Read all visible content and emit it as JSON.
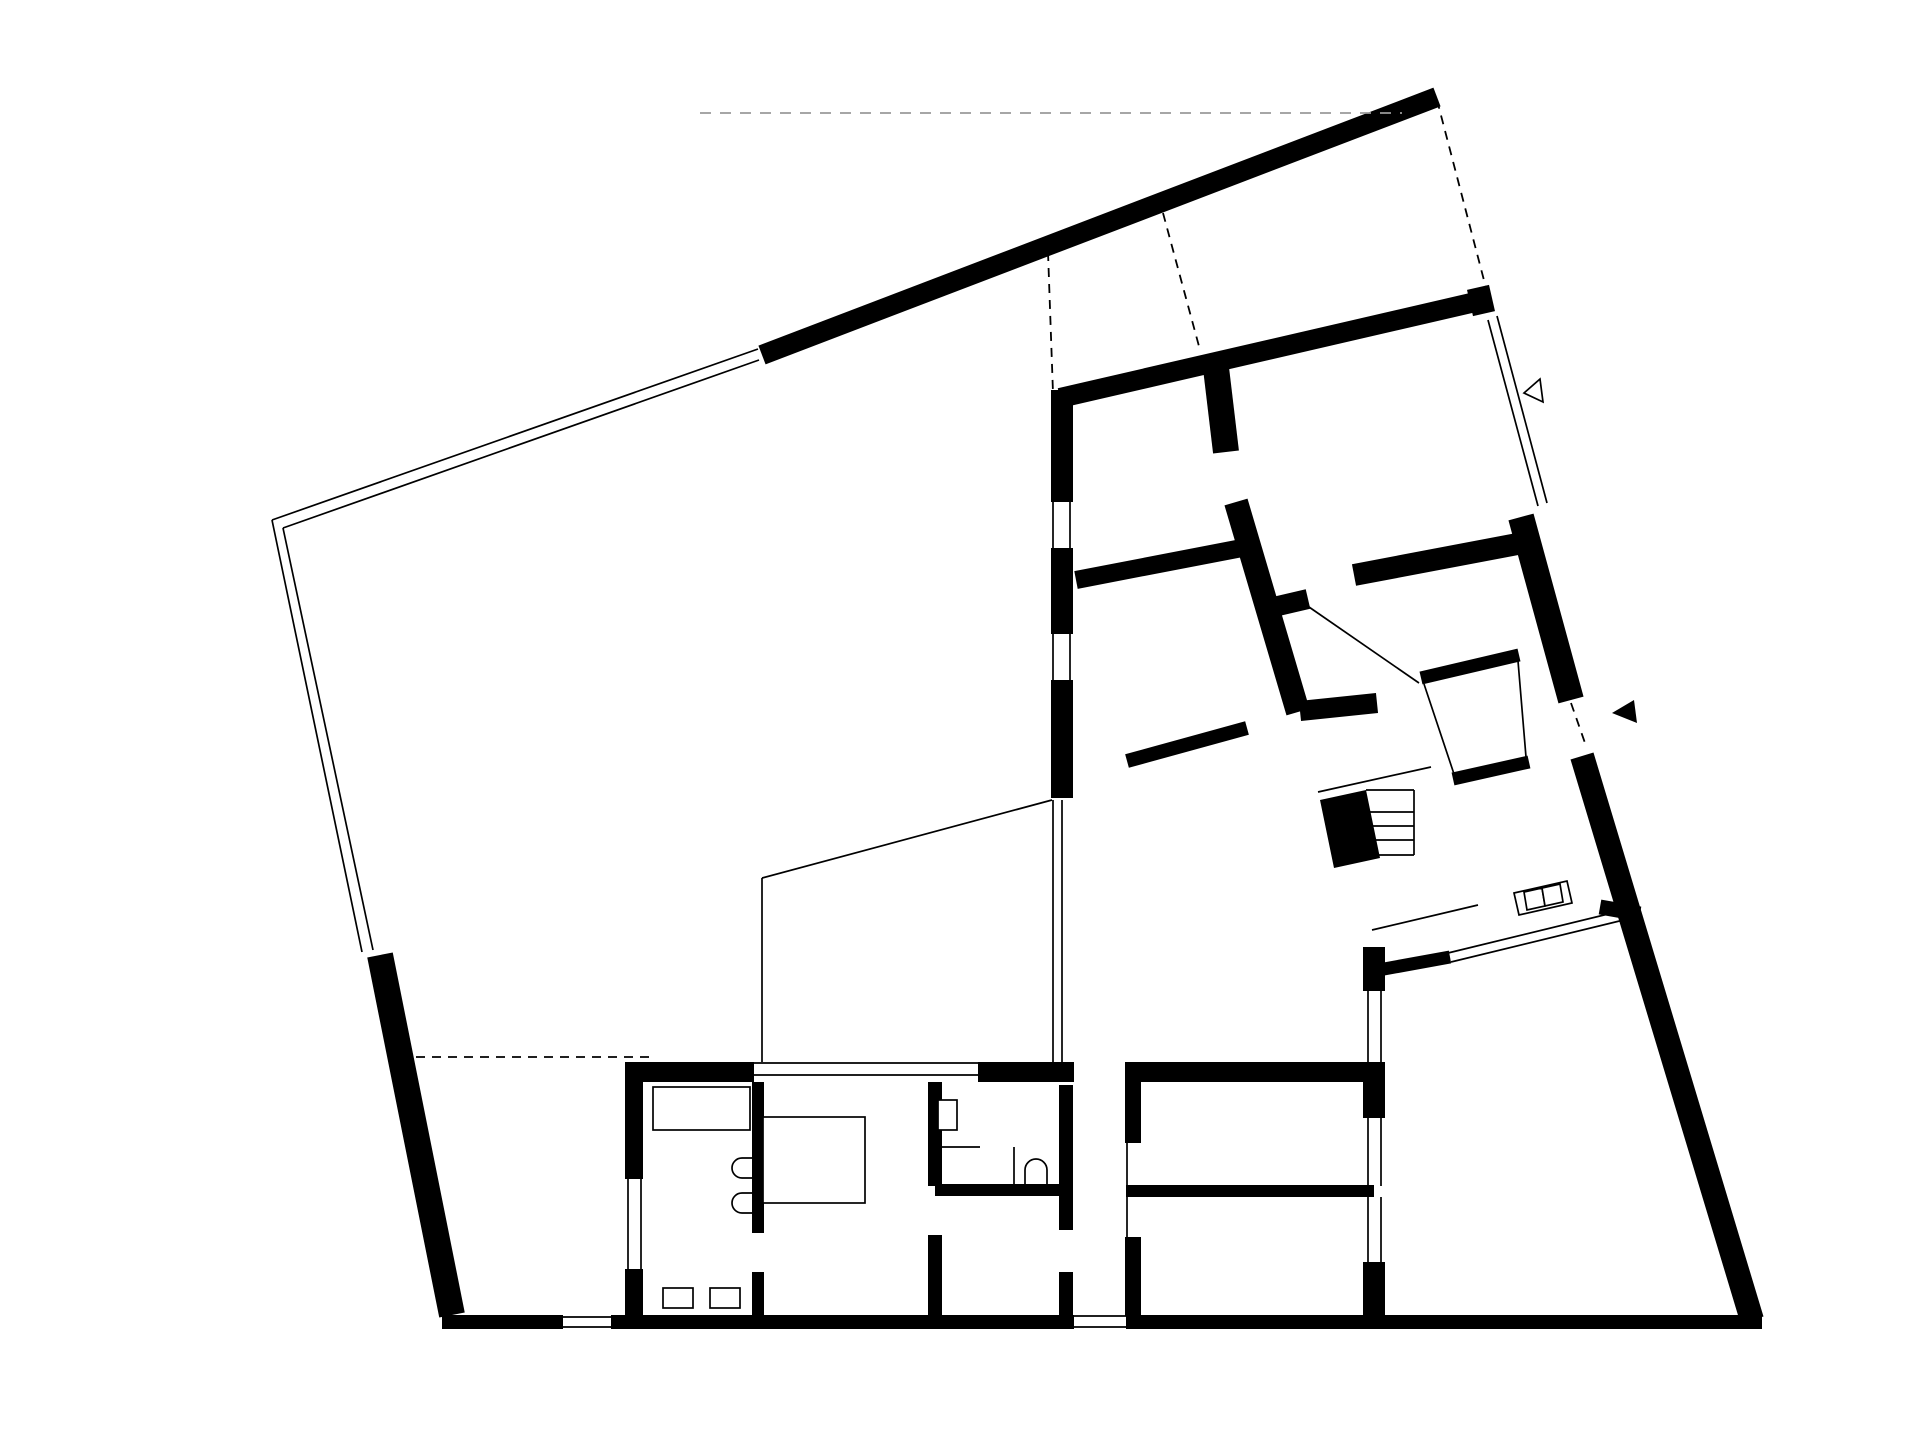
{
  "meta": {
    "drawing": "architectural-floor-plan",
    "canvas": {
      "width": 1920,
      "height": 1437
    },
    "colors": {
      "ink": "#000000",
      "background": "#ffffff",
      "faint": "#9a9a9a"
    }
  },
  "plan": {
    "walls": [
      {
        "name": "boundary-wall-top",
        "x1": 762,
        "y1": 355,
        "x2": 1437,
        "y2": 97,
        "w": 20
      },
      {
        "name": "boundary-wall-left",
        "x1": 380,
        "y1": 955,
        "x2": 452,
        "y2": 1315,
        "w": 26
      },
      {
        "name": "boundary-wall-bottom-a",
        "x1": 442,
        "y1": 1322,
        "x2": 563,
        "y2": 1322,
        "w": 14
      },
      {
        "name": "boundary-wall-bottom-b",
        "x1": 611,
        "y1": 1322,
        "x2": 1074,
        "y2": 1322,
        "w": 14
      },
      {
        "name": "boundary-wall-bottom-c",
        "x1": 1126,
        "y1": 1322,
        "x2": 1762,
        "y2": 1322,
        "w": 14
      },
      {
        "name": "boundary-wall-right-upper",
        "x1": 1521,
        "y1": 517,
        "x2": 1571,
        "y2": 700,
        "w": 26
      },
      {
        "name": "boundary-wall-right-lower",
        "x1": 1582,
        "y1": 756,
        "x2": 1752,
        "y2": 1320,
        "w": 24
      },
      {
        "name": "house-wall-top",
        "x1": 1060,
        "y1": 398,
        "x2": 1484,
        "y2": 300,
        "w": 20
      },
      {
        "name": "house-wall-top-end-block",
        "x1": 1470,
        "y1": 303,
        "x2": 1492,
        "y2": 298,
        "w": 27
      },
      {
        "name": "house-wall-west-a",
        "x1": 1062,
        "y1": 390,
        "x2": 1062,
        "y2": 502,
        "w": 22
      },
      {
        "name": "house-wall-west-b",
        "x1": 1062,
        "y1": 548,
        "x2": 1062,
        "y2": 634,
        "w": 22
      },
      {
        "name": "house-wall-west-c",
        "x1": 1062,
        "y1": 680,
        "x2": 1062,
        "y2": 798,
        "w": 22
      },
      {
        "name": "partition-p1-upper",
        "x1": 1216,
        "y1": 368,
        "x2": 1226,
        "y2": 452,
        "w": 26
      },
      {
        "name": "partition-p1-lower",
        "x1": 1236,
        "y1": 502,
        "x2": 1298,
        "y2": 712,
        "w": 24
      },
      {
        "name": "partition-p1-stub",
        "x1": 1278,
        "y1": 606,
        "x2": 1308,
        "y2": 599,
        "w": 20
      },
      {
        "name": "partition-room-ab",
        "x1": 1076,
        "y1": 580,
        "x2": 1242,
        "y2": 548,
        "w": 18
      },
      {
        "name": "partition-hall-west",
        "x1": 1300,
        "y1": 711,
        "x2": 1377,
        "y2": 703,
        "w": 20
      },
      {
        "name": "partition-room-c-south",
        "x1": 1354,
        "y1": 575,
        "x2": 1528,
        "y2": 542,
        "w": 22
      },
      {
        "name": "closet-wall-nw",
        "x1": 1421,
        "y1": 678,
        "x2": 1519,
        "y2": 655,
        "w": 13
      },
      {
        "name": "closet-wall-se",
        "x1": 1453,
        "y1": 779,
        "x2": 1529,
        "y2": 762,
        "w": 13
      },
      {
        "name": "terrace-wall-top",
        "x1": 1373,
        "y1": 971,
        "x2": 1450,
        "y2": 957,
        "w": 13
      },
      {
        "name": "terrace-glazing-junction",
        "x1": 1600,
        "y1": 907,
        "x2": 1640,
        "y2": 914,
        "w": 15
      },
      {
        "name": "terrace-wall-west-a",
        "x1": 1374,
        "y1": 947,
        "x2": 1374,
        "y2": 991,
        "w": 22
      },
      {
        "name": "terrace-wall-west-b",
        "x1": 1374,
        "y1": 1062,
        "x2": 1374,
        "y2": 1118,
        "w": 22
      },
      {
        "name": "terrace-wall-west-c",
        "x1": 1374,
        "y1": 1262,
        "x2": 1374,
        "y2": 1316,
        "w": 22
      },
      {
        "name": "rooms-de-wall-top",
        "x1": 1126,
        "y1": 1072,
        "x2": 1374,
        "y2": 1072,
        "w": 20
      },
      {
        "name": "rooms-de-wall-west-a",
        "x1": 1133,
        "y1": 1062,
        "x2": 1133,
        "y2": 1143,
        "w": 16
      },
      {
        "name": "rooms-de-wall-west-b",
        "x1": 1133,
        "y1": 1237,
        "x2": 1133,
        "y2": 1316,
        "w": 16
      },
      {
        "name": "rooms-de-divider",
        "x1": 1126,
        "y1": 1191,
        "x2": 1374,
        "y2": 1191,
        "w": 12
      },
      {
        "name": "wing-wall-top-a",
        "x1": 625,
        "y1": 1072,
        "x2": 754,
        "y2": 1072,
        "w": 20
      },
      {
        "name": "wing-wall-top-b",
        "x1": 978,
        "y1": 1072,
        "x2": 1074,
        "y2": 1072,
        "w": 20
      },
      {
        "name": "utility-wall-west-a",
        "x1": 634,
        "y1": 1062,
        "x2": 634,
        "y2": 1179,
        "w": 18
      },
      {
        "name": "utility-wall-west-b",
        "x1": 634,
        "y1": 1269,
        "x2": 634,
        "y2": 1316,
        "w": 18
      },
      {
        "name": "utility-bedroom-divider-a",
        "x1": 758,
        "y1": 1082,
        "x2": 758,
        "y2": 1233,
        "w": 12
      },
      {
        "name": "utility-bedroom-divider-b",
        "x1": 758,
        "y1": 1272,
        "x2": 758,
        "y2": 1316,
        "w": 12
      },
      {
        "name": "bath-wall-west-a",
        "x1": 935,
        "y1": 1082,
        "x2": 935,
        "y2": 1186,
        "w": 14
      },
      {
        "name": "bath-wall-west-b",
        "x1": 935,
        "y1": 1235,
        "x2": 935,
        "y2": 1316,
        "w": 14
      },
      {
        "name": "bath-wall-east-a",
        "x1": 1066,
        "y1": 1085,
        "x2": 1066,
        "y2": 1230,
        "w": 14
      },
      {
        "name": "bath-wall-east-b",
        "x1": 1066,
        "y1": 1272,
        "x2": 1066,
        "y2": 1316,
        "w": 14
      },
      {
        "name": "bath-divider-south",
        "x1": 935,
        "y1": 1190,
        "x2": 1066,
        "y2": 1190,
        "w": 12
      },
      {
        "name": "kitchen-island-wall",
        "x1": 1127,
        "y1": 761,
        "x2": 1247,
        "y2": 728,
        "w": 14
      }
    ],
    "thin_lines": [
      {
        "name": "fence-top-outer",
        "x1": 272,
        "y1": 520,
        "x2": 758,
        "y2": 349
      },
      {
        "name": "fence-top-inner",
        "x1": 283,
        "y1": 528,
        "x2": 759,
        "y2": 360
      },
      {
        "name": "fence-left-outer",
        "x1": 272,
        "y1": 520,
        "x2": 362,
        "y2": 952
      },
      {
        "name": "fence-left-inner",
        "x1": 283,
        "y1": 528,
        "x2": 373,
        "y2": 950
      },
      {
        "name": "glazing-ne-a",
        "x1": 1488,
        "y1": 320,
        "x2": 1538,
        "y2": 506
      },
      {
        "name": "glazing-ne-b",
        "x1": 1497,
        "y1": 316,
        "x2": 1547,
        "y2": 503
      },
      {
        "name": "patio-glazing-a",
        "x1": 1053,
        "y1": 800,
        "x2": 1053,
        "y2": 1062
      },
      {
        "name": "patio-glazing-b",
        "x1": 1062,
        "y1": 800,
        "x2": 1062,
        "y2": 1062
      },
      {
        "name": "patio-edge-diagonal",
        "x1": 762,
        "y1": 878,
        "x2": 1052,
        "y2": 800
      },
      {
        "name": "patio-edge-west",
        "x1": 762,
        "y1": 878,
        "x2": 762,
        "y2": 1062
      },
      {
        "name": "window-west1-a",
        "x1": 1053,
        "y1": 502,
        "x2": 1053,
        "y2": 548
      },
      {
        "name": "window-west1-b",
        "x1": 1070,
        "y1": 502,
        "x2": 1070,
        "y2": 548
      },
      {
        "name": "window-west2-a",
        "x1": 1053,
        "y1": 634,
        "x2": 1053,
        "y2": 680
      },
      {
        "name": "window-west2-b",
        "x1": 1070,
        "y1": 634,
        "x2": 1070,
        "y2": 680
      },
      {
        "name": "window-bedroom-a",
        "x1": 754,
        "y1": 1063,
        "x2": 978,
        "y2": 1063
      },
      {
        "name": "window-bedroom-b",
        "x1": 754,
        "y1": 1075,
        "x2": 978,
        "y2": 1075
      },
      {
        "name": "window-utility-a",
        "x1": 628,
        "y1": 1179,
        "x2": 628,
        "y2": 1269
      },
      {
        "name": "window-utility-b",
        "x1": 641,
        "y1": 1179,
        "x2": 641,
        "y2": 1269
      },
      {
        "name": "window-terrace1-a",
        "x1": 1368,
        "y1": 991,
        "x2": 1368,
        "y2": 1062
      },
      {
        "name": "window-terrace1-b",
        "x1": 1381,
        "y1": 991,
        "x2": 1381,
        "y2": 1062
      },
      {
        "name": "window-terrace2-a",
        "x1": 1368,
        "y1": 1118,
        "x2": 1368,
        "y2": 1186
      },
      {
        "name": "window-terrace2-b",
        "x1": 1381,
        "y1": 1118,
        "x2": 1381,
        "y2": 1186
      },
      {
        "name": "window-terrace3-a",
        "x1": 1368,
        "y1": 1197,
        "x2": 1368,
        "y2": 1262
      },
      {
        "name": "window-terrace3-b",
        "x1": 1381,
        "y1": 1197,
        "x2": 1381,
        "y2": 1262
      },
      {
        "name": "door-line-rooms-de",
        "x1": 1127,
        "y1": 1143,
        "x2": 1127,
        "y2": 1237
      },
      {
        "name": "gate-line-a",
        "x1": 563,
        "y1": 1317,
        "x2": 611,
        "y2": 1317
      },
      {
        "name": "gate-line-b",
        "x1": 563,
        "y1": 1327,
        "x2": 611,
        "y2": 1327
      },
      {
        "name": "window-hall-south-a",
        "x1": 1074,
        "y1": 1316,
        "x2": 1126,
        "y2": 1316
      },
      {
        "name": "window-hall-south-b",
        "x1": 1074,
        "y1": 1327,
        "x2": 1126,
        "y2": 1327
      },
      {
        "name": "terrace-glazing-a",
        "x1": 1448,
        "y1": 953,
        "x2": 1637,
        "y2": 907
      },
      {
        "name": "terrace-glazing-b",
        "x1": 1451,
        "y1": 962,
        "x2": 1640,
        "y2": 916
      },
      {
        "name": "kitchen-glazing-line",
        "x1": 1372,
        "y1": 930,
        "x2": 1478,
        "y2": 905
      },
      {
        "name": "door-swing-room-c",
        "x1": 1309,
        "y1": 607,
        "x2": 1419,
        "y2": 683
      },
      {
        "name": "closet-side-sw",
        "x1": 1424,
        "y1": 684,
        "x2": 1454,
        "y2": 774
      },
      {
        "name": "closet-side-ne",
        "x1": 1518,
        "y1": 661,
        "x2": 1526,
        "y2": 757
      },
      {
        "name": "stair-rail",
        "x1": 1318,
        "y1": 792,
        "x2": 1431,
        "y2": 767
      },
      {
        "name": "stair-edge-top",
        "x1": 1366,
        "y1": 790,
        "x2": 1414,
        "y2": 790
      },
      {
        "name": "stair-tread-1",
        "x1": 1366,
        "y1": 812,
        "x2": 1414,
        "y2": 812
      },
      {
        "name": "stair-tread-2",
        "x1": 1366,
        "y1": 826,
        "x2": 1414,
        "y2": 826
      },
      {
        "name": "stair-tread-3",
        "x1": 1366,
        "y1": 840,
        "x2": 1414,
        "y2": 840
      },
      {
        "name": "stair-edge-bottom",
        "x1": 1366,
        "y1": 855,
        "x2": 1414,
        "y2": 855
      },
      {
        "name": "stair-edge-right",
        "x1": 1414,
        "y1": 790,
        "x2": 1414,
        "y2": 855
      },
      {
        "name": "bed-fold-line",
        "x1": 775,
        "y1": 1117,
        "x2": 790,
        "y2": 1203
      },
      {
        "name": "bath-screen-line",
        "x1": 1014,
        "y1": 1147,
        "x2": 1014,
        "y2": 1188
      },
      {
        "name": "bath-shelf-line",
        "x1": 938,
        "y1": 1147,
        "x2": 980,
        "y2": 1147
      }
    ],
    "dashed_lines": [
      {
        "name": "dash-roof-edge-west",
        "x1": 1048,
        "y1": 252,
        "x2": 1053,
        "y2": 393,
        "faint": false
      },
      {
        "name": "dash-roof-edge-mid",
        "x1": 1163,
        "y1": 213,
        "x2": 1200,
        "y2": 350,
        "faint": false
      },
      {
        "name": "dash-boundary-ne",
        "x1": 1437,
        "y1": 100,
        "x2": 1486,
        "y2": 288,
        "faint": false
      },
      {
        "name": "dash-patio-south",
        "x1": 400,
        "y1": 1057,
        "x2": 650,
        "y2": 1057,
        "faint": false
      },
      {
        "name": "dash-entry-door",
        "x1": 1571,
        "y1": 703,
        "x2": 1585,
        "y2": 743,
        "faint": false
      },
      {
        "name": "dash-site-line",
        "x1": 700,
        "y1": 113,
        "x2": 1402,
        "y2": 113,
        "faint": true
      }
    ],
    "solid_polygons": [
      {
        "name": "stair-block",
        "points": "1320,800 1366,790 1380,858 1334,868"
      },
      {
        "name": "entry-arrow-icon",
        "points": "1612,713 1634,700 1637,723"
      }
    ],
    "outline_polygons": [
      {
        "name": "view-marker-icon",
        "points": "1524,393 1540,379 1543,402"
      },
      {
        "name": "kitchen-counter",
        "points": "1514,893 1567,881 1572,903 1519,915"
      },
      {
        "name": "kitchen-sink-cell-1",
        "points": "1524,892 1542,888 1545,906 1527,910"
      },
      {
        "name": "kitchen-sink-cell-2",
        "points": "1542,888 1560,884 1563,902 1545,906"
      }
    ],
    "outline_rects": [
      {
        "name": "utility-counter",
        "x": 653,
        "y": 1087,
        "w": 97,
        "h": 43
      },
      {
        "name": "utility-box-1",
        "x": 663,
        "y": 1288,
        "w": 30,
        "h": 20
      },
      {
        "name": "utility-box-2",
        "x": 710,
        "y": 1288,
        "w": 30,
        "h": 20
      },
      {
        "name": "bed",
        "x": 763,
        "y": 1117,
        "w": 102,
        "h": 86
      },
      {
        "name": "wc-cistern",
        "x": 938,
        "y": 1100,
        "w": 19,
        "h": 30
      }
    ],
    "fixture_paths": [
      {
        "name": "washer-1",
        "d": "M755,1158 L742,1158 A10,10 0 0 0 742,1178 L755,1178"
      },
      {
        "name": "washer-2",
        "d": "M755,1193 L742,1193 A10,10 0 0 0 742,1213 L755,1213"
      },
      {
        "name": "basin",
        "d": "M1025,1188 L1025,1170 A11,11 0 0 1 1047,1170 L1047,1188"
      }
    ]
  }
}
